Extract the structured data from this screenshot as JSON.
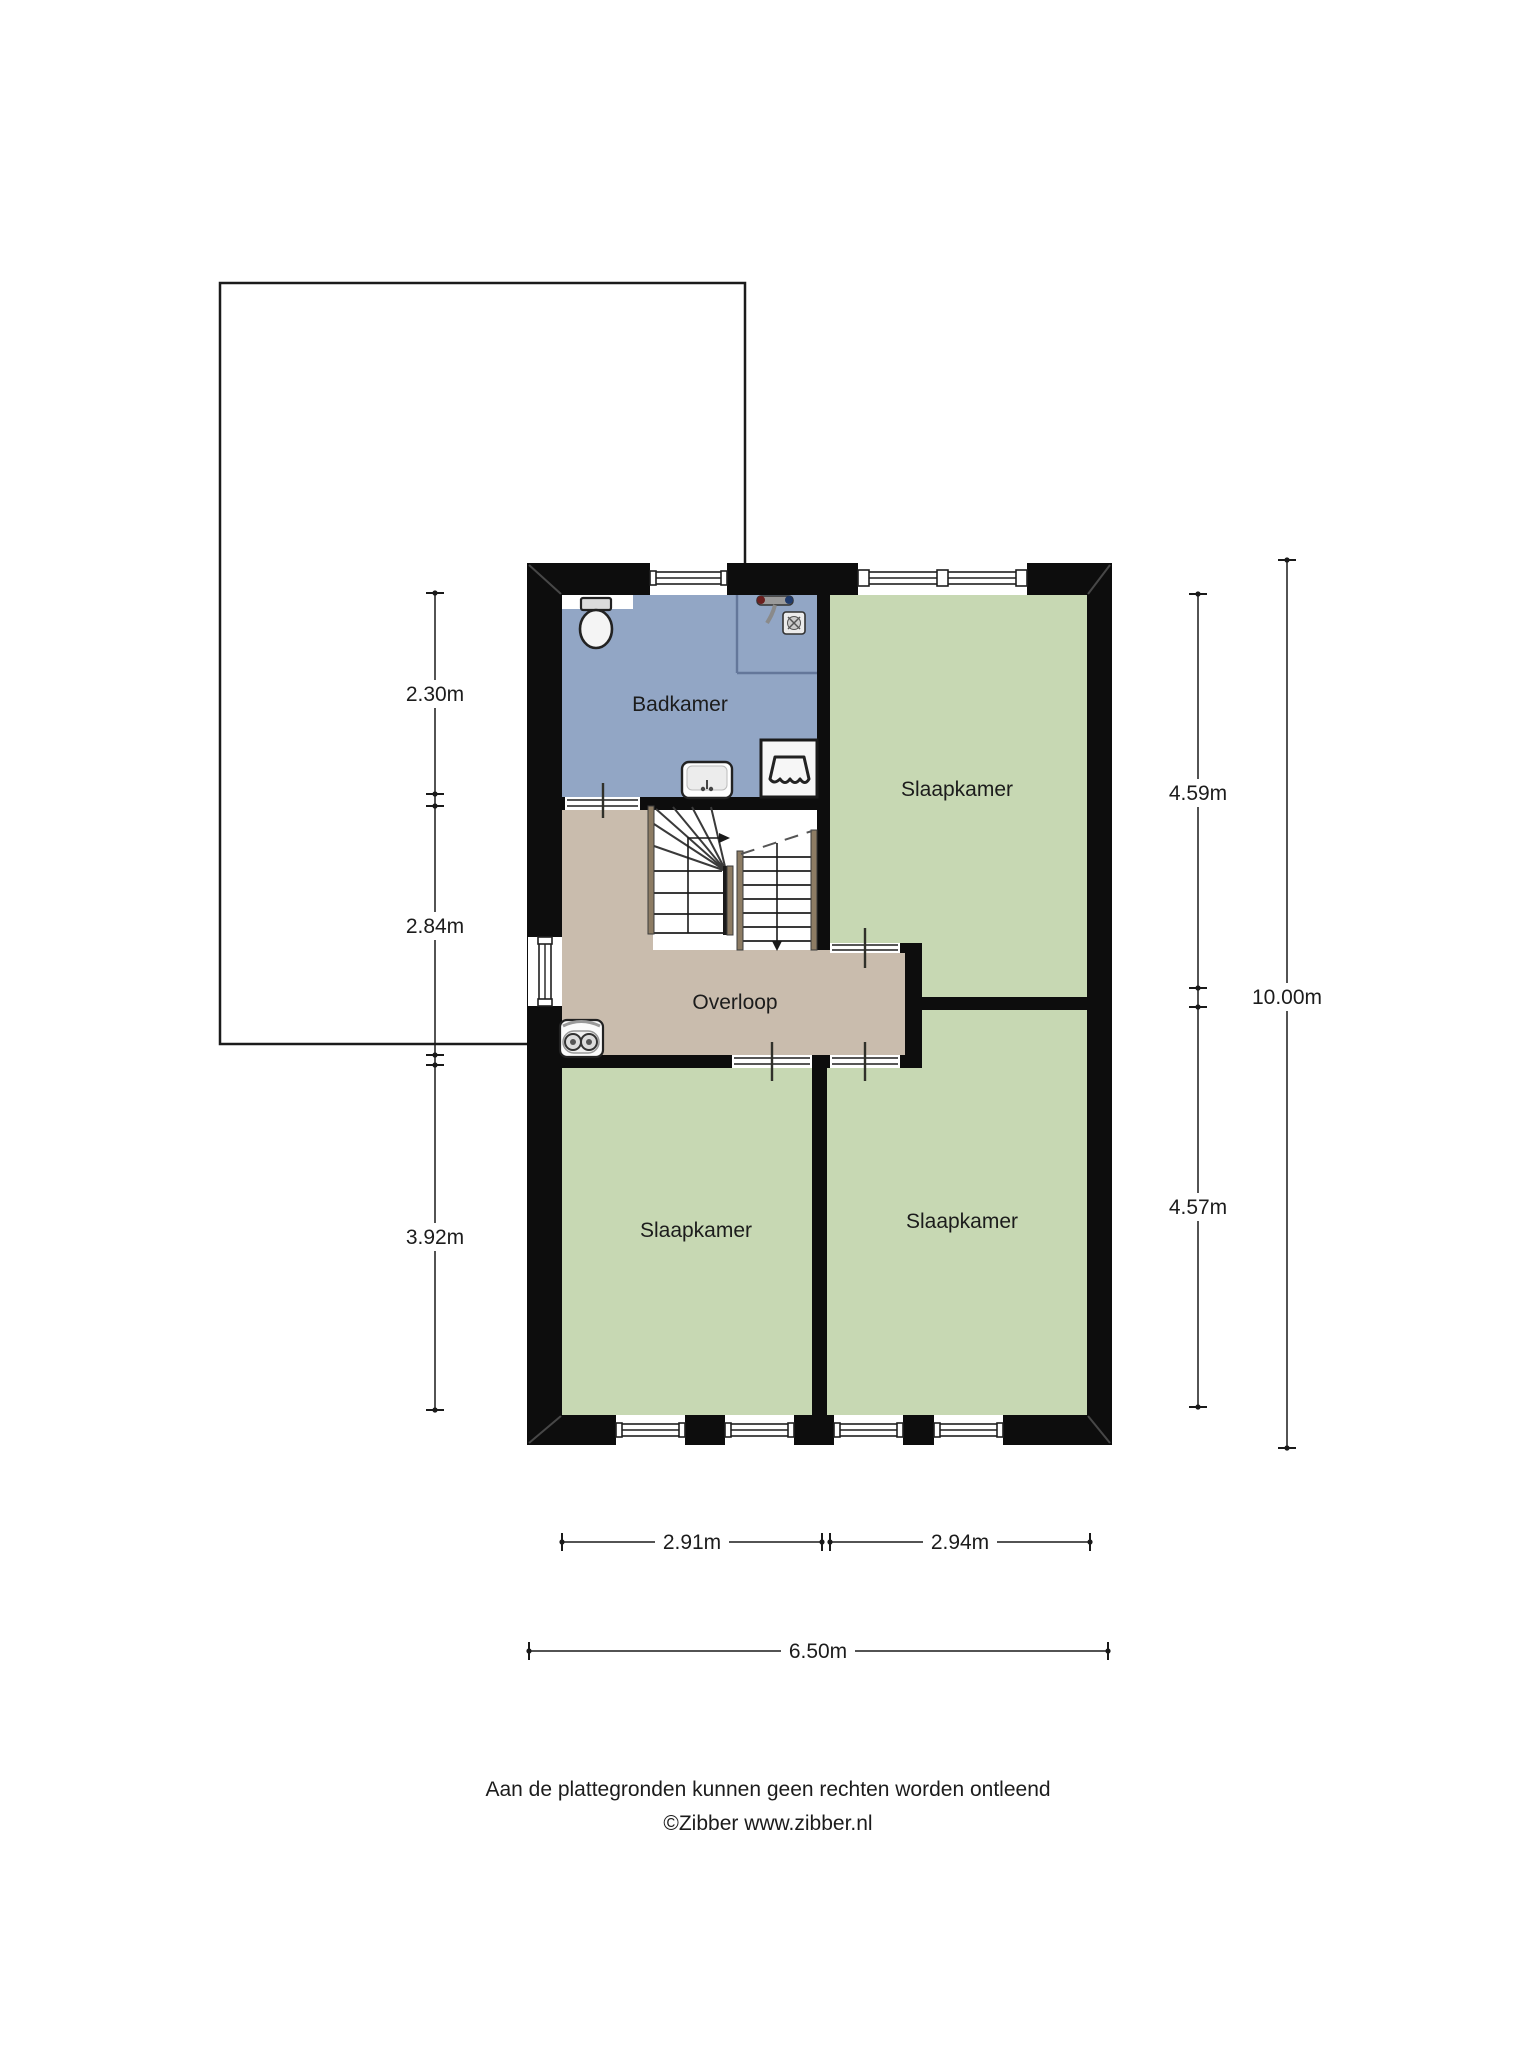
{
  "floorplan": {
    "rooms": {
      "badkamer": {
        "label": "Badkamer"
      },
      "slaapkamer_top": {
        "label": "Slaapkamer"
      },
      "overloop": {
        "label": "Overloop"
      },
      "slaapkamer_left": {
        "label": "Slaapkamer"
      },
      "slaapkamer_right": {
        "label": "Slaapkamer"
      }
    },
    "dimensions": {
      "left_upper": "2.30m",
      "left_middle": "2.84m",
      "left_lower": "3.92m",
      "right_upper": "4.59m",
      "right_lower": "4.57m",
      "right_total": "10.00m",
      "bottom_left": "2.91m",
      "bottom_right": "2.94m",
      "bottom_total": "6.50m"
    },
    "colors": {
      "bathroom_fill": "#92a6c5",
      "bedroom_fill": "#c7d8b3",
      "landing_fill": "#c9bcad",
      "wall_fill": "#0d0d0d",
      "stair_wood_fill": "#8d7c64"
    }
  },
  "footer": {
    "disclaimer": "Aan de plattegronden kunnen geen rechten worden ontleend",
    "copyright": "©Zibber www.zibber.nl"
  }
}
